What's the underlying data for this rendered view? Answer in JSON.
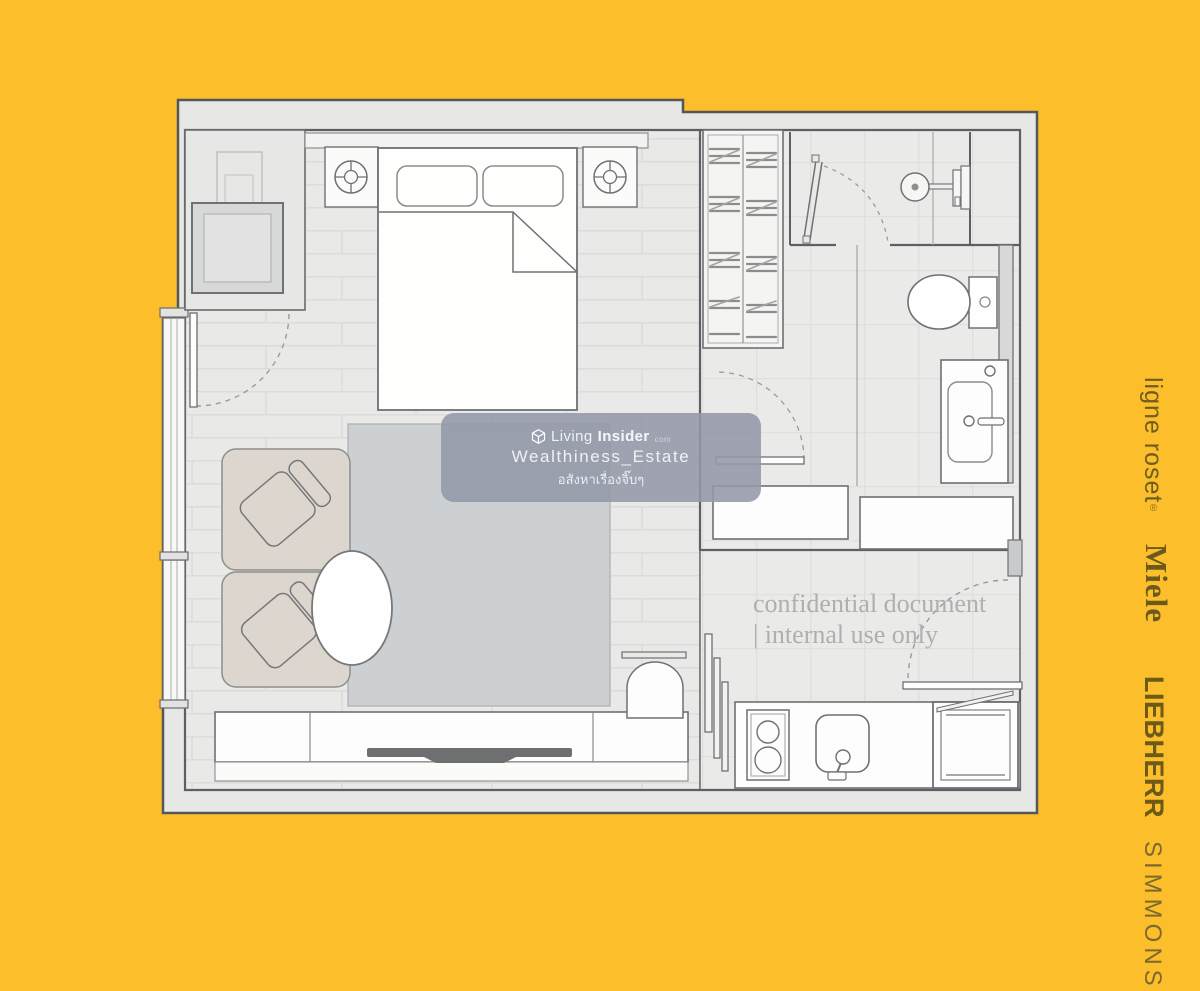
{
  "watermark": {
    "brand_light": "Living",
    "brand_bold": "Insider",
    "brand_domain": "com",
    "handle": "Wealthiness_Estate",
    "tagline": "อสังหาเรื่องจิ๊บๆ",
    "box_color": "#9397A9"
  },
  "confidential": {
    "line1": "confidential document",
    "line2": "| internal use only",
    "color": "#AFAFAF"
  },
  "brands": {
    "items": [
      {
        "label": "ligne roset",
        "reg": "®"
      },
      {
        "label": "Miele"
      },
      {
        "label": "LIEBHERR"
      },
      {
        "label": "SIMMONS"
      }
    ],
    "color": "#6B5A1B"
  },
  "colors": {
    "background": "#FCBE2B",
    "plan_slab": "#E7E7E6",
    "wall_line": "#55565A",
    "furniture_line": "#6F7073",
    "rug": "#CDD0D3",
    "armchair": "#DCD6CE",
    "tv": "#6E6F71"
  }
}
